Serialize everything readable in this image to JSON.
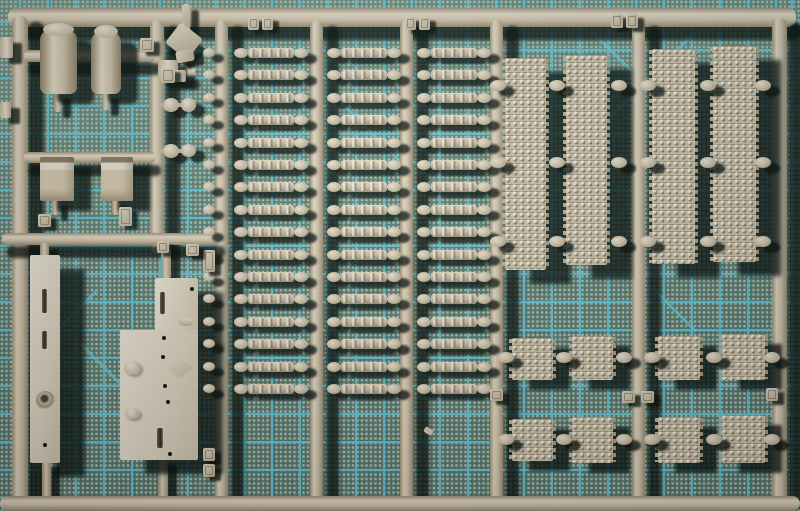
{
  "scene": {
    "description": "Photograph of a tan plastic model-kit sprue with tank track parts on a green self-healing cutting mat with cyan grid lines",
    "width": 800,
    "height": 511,
    "visible_text": "none (moulded part-number tags are illegible)"
  },
  "colors": {
    "mat_base": "#5e7e73",
    "mat_grid": "#5fc8de",
    "mat_dot": "#a9c2b2",
    "plastic_light": "#f0e6d2",
    "plastic_mid": "#d6c9b0",
    "plastic_dark": "#9a8c72",
    "shadow": "rgba(7,14,10,0.78)"
  },
  "counts": {
    "individual_track_links": 48,
    "long_track_runs": 4,
    "short_track_segments": 8,
    "cylindrical_drum_parts": 2,
    "stowage_box_parts": 2,
    "flat_hull_plates": 3,
    "part_number_tags": 19
  },
  "mat": {
    "grid_cell_px": 28,
    "diagonals": [
      [
        588,
        138,
        150,
        -45
      ],
      [
        592,
        30,
        148,
        45
      ],
      [
        332,
        92,
        100,
        45
      ],
      [
        48,
        338,
        70,
        -45
      ],
      [
        80,
        342,
        72,
        45
      ],
      [
        652,
        286,
        62,
        45
      ]
    ]
  },
  "sprue": {
    "rails_horizontal": [
      [
        8,
        8,
        788,
        19
      ],
      [
        0,
        496,
        800,
        15
      ]
    ],
    "rails_vertical": [
      [
        12,
        16,
        16,
        488
      ],
      [
        150,
        20,
        14,
        234
      ],
      [
        215,
        20,
        13,
        483
      ],
      [
        310,
        20,
        13,
        483
      ],
      [
        400,
        20,
        13,
        483
      ],
      [
        490,
        20,
        13,
        483
      ],
      [
        632,
        20,
        13,
        483
      ],
      [
        772,
        18,
        15,
        485
      ]
    ],
    "subrunners": [
      [
        24,
        50,
        132,
        12
      ],
      [
        163,
        66,
        32,
        11
      ],
      [
        24,
        152,
        132,
        11
      ],
      [
        2,
        233,
        218,
        12
      ]
    ],
    "track_links": {
      "columns_x": [
        234,
        327,
        417
      ],
      "rows": 16,
      "y_start": 48,
      "pitch": 22.4,
      "blob_w": 14,
      "blob_h": 10,
      "body_w": 46,
      "body_h": 10,
      "rail_bump_x": 203,
      "rail_bump_w": 12,
      "rail_bump_h": 9
    },
    "long_track_runs": [
      [
        505,
        58,
        41,
        212
      ],
      [
        566,
        55,
        41,
        210
      ],
      [
        652,
        49,
        43,
        215
      ],
      [
        713,
        46,
        43,
        216
      ]
    ],
    "long_track_blob_rows_y": [
      80,
      157,
      236
    ],
    "long_track_blob_xs": [
      490,
      549,
      611,
      640,
      700,
      755
    ],
    "track_segments": [
      [
        512,
        338,
        41,
        42
      ],
      [
        572,
        336,
        41,
        44
      ],
      [
        658,
        336,
        42,
        44
      ],
      [
        722,
        334,
        43,
        46
      ],
      [
        512,
        419,
        41,
        42
      ],
      [
        572,
        417,
        41,
        46
      ],
      [
        658,
        417,
        42,
        46
      ],
      [
        722,
        415,
        43,
        48
      ]
    ],
    "segment_blob_rows_y": [
      352,
      434
    ],
    "segment_blob_xs": [
      498,
      556,
      616,
      644,
      706,
      764
    ],
    "gate_blob_w": 16,
    "gate_blob_h": 11,
    "parts": [
      {
        "t": "stem",
        "r": [
          54,
          92,
          8,
          20
        ]
      },
      {
        "t": "stem",
        "r": [
          102,
          92,
          8,
          18
        ]
      },
      {
        "t": "stem",
        "r": [
          52,
          199,
          7,
          16
        ]
      },
      {
        "t": "stem",
        "r": [
          112,
          199,
          7,
          16
        ]
      },
      {
        "t": "stem",
        "r": [
          40,
          243,
          9,
          14
        ]
      },
      {
        "t": "stem",
        "r": [
          161,
          245,
          10,
          34
        ]
      },
      {
        "t": "stem",
        "r": [
          42,
          461,
          9,
          38
        ]
      },
      {
        "t": "stem",
        "r": [
          158,
          458,
          10,
          40
        ]
      },
      {
        "t": "plate",
        "r": [
          30,
          255,
          30,
          208
        ],
        "details": [
          [
            "slot",
            12,
            34,
            5,
            24
          ],
          [
            "slot",
            12,
            76,
            5,
            18
          ],
          [
            "ring",
            6,
            136,
            19,
            19
          ],
          [
            "hole",
            13,
            188,
            4,
            4
          ]
        ]
      },
      {
        "t": "plate",
        "r": [
          155,
          278,
          43,
          56
        ],
        "details": [
          [
            "slot",
            5,
            14,
            5,
            22
          ],
          [
            "hole",
            35,
            9,
            4,
            4
          ],
          [
            "oval",
            23,
            40,
            16,
            8
          ]
        ]
      },
      {
        "t": "plate",
        "r": [
          120,
          330,
          78,
          130
        ],
        "details": [
          [
            "cap",
            4,
            31,
            17,
            14
          ],
          [
            "diamond",
            45,
            28,
            28,
            20
          ],
          [
            "cap",
            5,
            78,
            15,
            11
          ],
          [
            "hole",
            42,
            6,
            4,
            4
          ],
          [
            "hole",
            41,
            25,
            4,
            4
          ],
          [
            "hole",
            43,
            54,
            4,
            4
          ],
          [
            "hole",
            46,
            70,
            4,
            4
          ],
          [
            "hole",
            48,
            122,
            4,
            4
          ],
          [
            "slot",
            37,
            98,
            6,
            20
          ]
        ]
      },
      {
        "t": "block",
        "r": [
          0,
          37,
          13,
          21
        ]
      },
      {
        "t": "block",
        "r": [
          0,
          102,
          11,
          16
        ]
      },
      {
        "t": "block",
        "r": [
          158,
          60,
          20,
          18
        ]
      },
      {
        "t": "block",
        "r": [
          170,
          70,
          16,
          12
        ]
      },
      {
        "t": "box",
        "r": [
          40,
          157,
          34,
          44
        ]
      },
      {
        "t": "box",
        "r": [
          101,
          157,
          32,
          44
        ]
      },
      {
        "t": "drum",
        "r": [
          40,
          30,
          37,
          64
        ]
      },
      {
        "t": "drum",
        "r": [
          91,
          32,
          30,
          62
        ]
      },
      {
        "t": "gun",
        "r": [
          168,
          4,
          40,
          60
        ],
        "children": [
          [
            "gpart",
            14,
            0,
            8,
            28,
            0
          ],
          [
            "gpart",
            2,
            24,
            28,
            26,
            38
          ],
          [
            "gpart",
            8,
            46,
            18,
            12,
            -10
          ]
        ]
      },
      {
        "t": "knob",
        "r": [
          163,
          98,
          16,
          14
        ]
      },
      {
        "t": "knob",
        "r": [
          181,
          98,
          15,
          14
        ]
      },
      {
        "t": "knob",
        "r": [
          163,
          144,
          16,
          14
        ]
      },
      {
        "t": "knob",
        "r": [
          181,
          144,
          15,
          13
        ]
      },
      {
        "t": "speck",
        "r": [
          424,
          428,
          9,
          6
        ],
        "rot": 30
      }
    ],
    "tags": [
      [
        248,
        17,
        11,
        13
      ],
      [
        262,
        17,
        11,
        13
      ],
      [
        405,
        17,
        11,
        13
      ],
      [
        419,
        17,
        11,
        13
      ],
      [
        611,
        14,
        12,
        14
      ],
      [
        626,
        14,
        12,
        14
      ],
      [
        140,
        38,
        14,
        14
      ],
      [
        161,
        68,
        14,
        15
      ],
      [
        203,
        250,
        12,
        22
      ],
      [
        203,
        448,
        12,
        13
      ],
      [
        203,
        464,
        12,
        13
      ],
      [
        119,
        207,
        13,
        19
      ],
      [
        38,
        214,
        13,
        13
      ],
      [
        157,
        241,
        12,
        12
      ],
      [
        186,
        244,
        13,
        12
      ],
      [
        490,
        389,
        13,
        12
      ],
      [
        622,
        391,
        13,
        12
      ],
      [
        641,
        391,
        13,
        12
      ],
      [
        766,
        388,
        12,
        13
      ]
    ]
  }
}
